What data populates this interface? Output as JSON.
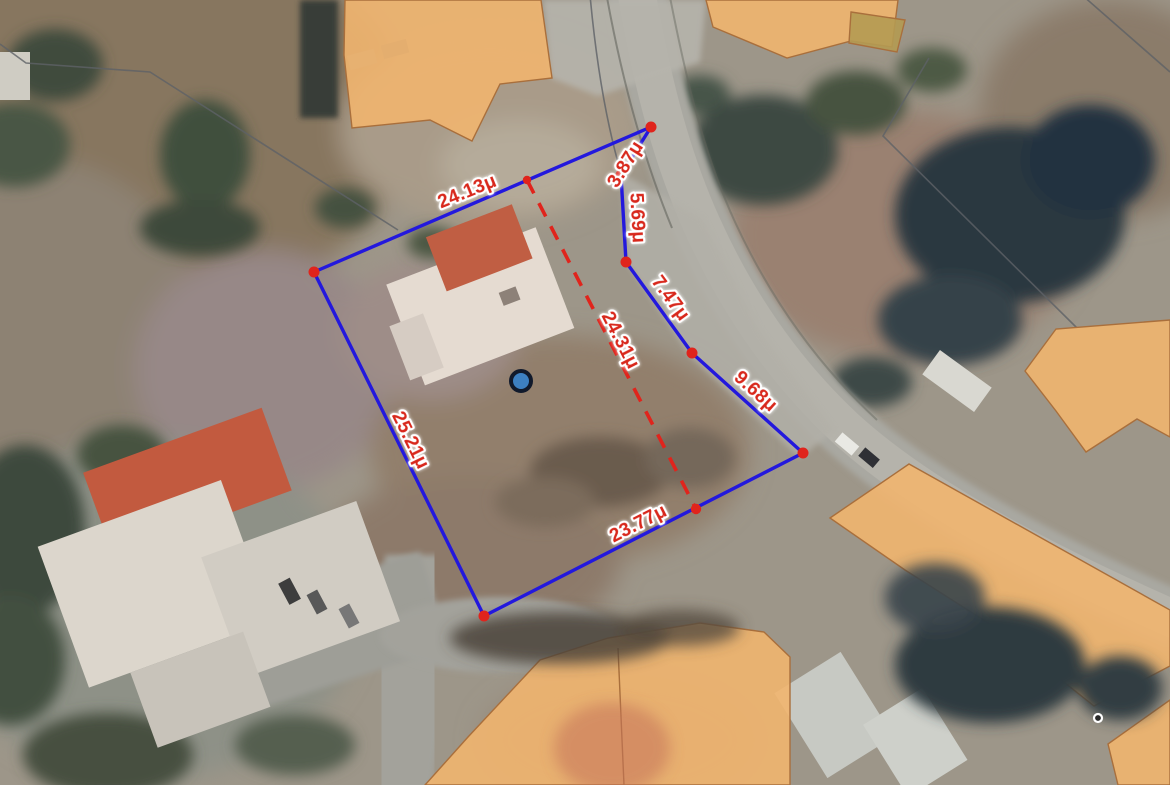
{
  "map": {
    "kind": "aerial-cadastral-measurement",
    "unit_suffix": "μ",
    "colors": {
      "parcel_stroke": "#2318dd",
      "measure_red": "#e0241c",
      "label_fill": "#d8281c",
      "label_halo": "#ffffff",
      "marker_fill": "#3d80c2",
      "marker_ring": "#111a2c",
      "poi_fill": "#2a2a2a",
      "poi_ring": "#ffffff",
      "building_overlay": "#f1b56f",
      "building_overlay_border": "#a96f3c"
    },
    "parcel": {
      "vertices": [
        {
          "x": 314,
          "y": 272
        },
        {
          "x": 651,
          "y": 127
        },
        {
          "x": 621,
          "y": 175
        },
        {
          "x": 626,
          "y": 262
        },
        {
          "x": 692,
          "y": 353
        },
        {
          "x": 803,
          "y": 453
        },
        {
          "x": 484,
          "y": 616
        }
      ],
      "edge_labels": [
        {
          "text": "24.13μ",
          "x": 467,
          "y": 191,
          "angle": -22
        },
        {
          "text": "3.87μ",
          "x": 625,
          "y": 164,
          "angle": -58
        },
        {
          "text": "5.69μ",
          "x": 638,
          "y": 218,
          "angle": 87
        },
        {
          "text": "7.47μ",
          "x": 671,
          "y": 298,
          "angle": 54
        },
        {
          "text": "9.68μ",
          "x": 756,
          "y": 391,
          "angle": 42
        },
        {
          "text": "25.21μ",
          "x": 411,
          "y": 440,
          "angle": 64
        },
        {
          "text": "23.77μ",
          "x": 638,
          "y": 523,
          "angle": -27
        }
      ],
      "diagonal": {
        "from": {
          "x": 527,
          "y": 180
        },
        "to": {
          "x": 696,
          "y": 509
        },
        "label": {
          "text": "24.31μ",
          "x": 621,
          "y": 340,
          "angle": 63
        }
      },
      "marker": {
        "x": 521,
        "y": 381
      }
    },
    "poi": {
      "x": 1098,
      "y": 718
    }
  }
}
